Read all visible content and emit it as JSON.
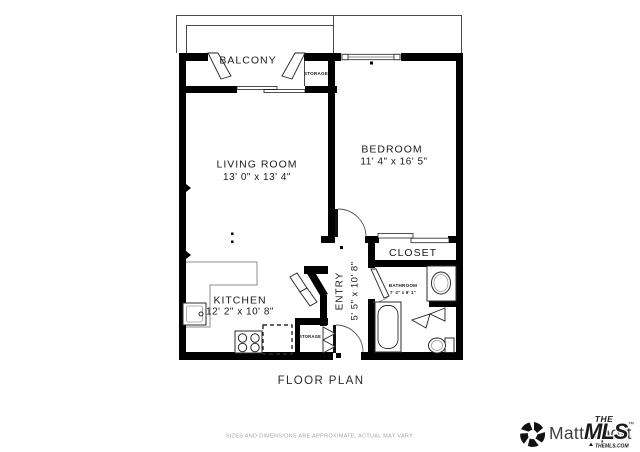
{
  "plan": {
    "caption": "FLOOR PLAN",
    "rooms": {
      "balcony": {
        "label": "BALCONY"
      },
      "balcony_storage": {
        "label": "STORAGE"
      },
      "living_room": {
        "label": "LIVING ROOM",
        "dimensions": "13' 0\" x 13' 4\""
      },
      "bedroom": {
        "label": "BEDROOM",
        "dimensions": "11' 4\" x 16' 5\""
      },
      "closet": {
        "label": "CLOSET"
      },
      "bathroom": {
        "label": "BATHROOM",
        "dimensions": "7' 4\" x 9' 1\""
      },
      "entry": {
        "label": "ENTRY",
        "dimensions": "5' 5\" x 10' 8\""
      },
      "kitchen": {
        "label": "KITCHEN",
        "dimensions": "12' 2\" x 10' 8\""
      },
      "entry_storage": {
        "label": "STORAGE"
      }
    }
  },
  "footer": {
    "disclaimer": "SIZES AND DIMENSIONS ARE APPROXIMATE, ACTUAL MAY VARY.",
    "matterport_wordmark": "Matterport",
    "mls": {
      "the": "THE",
      "name": "MLS",
      "trademark": "™",
      "site": "THEMLS.COM"
    }
  },
  "colors": {
    "wall": "#000000",
    "mls_red": "#d7282f",
    "matterport_text": "#3f3f3f",
    "disclaimer_gray": "#a6a6a6"
  }
}
